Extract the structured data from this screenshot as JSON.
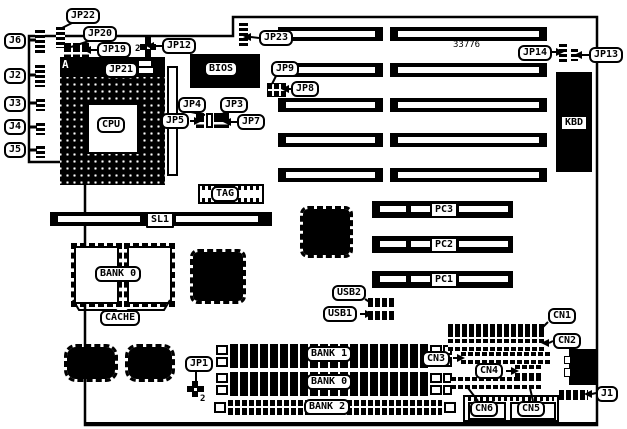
{
  "diagram_title": "motherboard-jumper-diagram",
  "colors": {
    "ink": "#000000",
    "paper": "#ffffff"
  },
  "outline": {
    "points": "29,36 233,36 233,17 597,17 597,425 85,425 85,162 29,162",
    "bottom_edge": {
      "x1": 85,
      "y1": 424,
      "x2": 597,
      "y2": 424,
      "w": 4
    }
  },
  "labels": [
    {
      "id": "jp22",
      "text": "JP22",
      "x": 66,
      "y": 8
    },
    {
      "id": "jp20",
      "text": "JP20",
      "x": 83,
      "y": 26
    },
    {
      "id": "jp19",
      "text": "JP19",
      "x": 97,
      "y": 42
    },
    {
      "id": "jp12",
      "text": "JP12",
      "x": 162,
      "y": 38
    },
    {
      "id": "jp21",
      "text": "JP21",
      "x": 104,
      "y": 62
    },
    {
      "id": "j6",
      "text": "J6",
      "x": 4,
      "y": 33
    },
    {
      "id": "j2",
      "text": "J2",
      "x": 4,
      "y": 68
    },
    {
      "id": "j3",
      "text": "J3",
      "x": 4,
      "y": 96
    },
    {
      "id": "j4",
      "text": "J4",
      "x": 4,
      "y": 119
    },
    {
      "id": "j5",
      "text": "J5",
      "x": 4,
      "y": 142
    },
    {
      "id": "jp23",
      "text": "JP23",
      "x": 259,
      "y": 30
    },
    {
      "id": "jp9",
      "text": "JP9",
      "x": 271,
      "y": 61
    },
    {
      "id": "jp8",
      "text": "JP8",
      "x": 291,
      "y": 81
    },
    {
      "id": "jp4",
      "text": "JP4",
      "x": 178,
      "y": 97
    },
    {
      "id": "jp3",
      "text": "JP3",
      "x": 220,
      "y": 97
    },
    {
      "id": "jp5",
      "text": "JP5",
      "x": 161,
      "y": 113
    },
    {
      "id": "jp7",
      "text": "JP7",
      "x": 237,
      "y": 114
    },
    {
      "id": "cpu",
      "text": "CPU",
      "x": 97,
      "y": 117
    },
    {
      "id": "bios",
      "text": "BIOS",
      "x": 204,
      "y": 61
    },
    {
      "id": "jp14",
      "text": "JP14",
      "x": 518,
      "y": 45
    },
    {
      "id": "jp13",
      "text": "JP13",
      "x": 589,
      "y": 47
    },
    {
      "id": "kbd",
      "text": "KBD",
      "x": 560,
      "y": 115,
      "variant": "flat"
    },
    {
      "id": "tag",
      "text": "TAG",
      "x": 211,
      "y": 186
    },
    {
      "id": "sl1",
      "text": "SL1",
      "x": 146,
      "y": 212,
      "variant": "flat"
    },
    {
      "id": "bank0-cache",
      "text": "BANK 0",
      "x": 95,
      "y": 266
    },
    {
      "id": "cache",
      "text": "CACHE",
      "x": 100,
      "y": 310
    },
    {
      "id": "pc3",
      "text": "PC3",
      "x": 430,
      "y": 202,
      "variant": "flat"
    },
    {
      "id": "pc2",
      "text": "PC2",
      "x": 430,
      "y": 237,
      "variant": "flat"
    },
    {
      "id": "pc1",
      "text": "PC1",
      "x": 430,
      "y": 272,
      "variant": "flat"
    },
    {
      "id": "usb2",
      "text": "USB2",
      "x": 332,
      "y": 285
    },
    {
      "id": "usb1",
      "text": "USB1",
      "x": 323,
      "y": 306
    },
    {
      "id": "jp1",
      "text": "JP1",
      "x": 185,
      "y": 356
    },
    {
      "id": "bank1",
      "text": "BANK 1",
      "x": 306,
      "y": 346
    },
    {
      "id": "bank0-simm",
      "text": "BANK 0",
      "x": 306,
      "y": 374
    },
    {
      "id": "bank2",
      "text": "BANK 2",
      "x": 304,
      "y": 399
    },
    {
      "id": "cn3",
      "text": "CN3",
      "x": 422,
      "y": 351
    },
    {
      "id": "cn1",
      "text": "CN1",
      "x": 548,
      "y": 308
    },
    {
      "id": "cn2",
      "text": "CN2",
      "x": 553,
      "y": 333
    },
    {
      "id": "cn4",
      "text": "CN4",
      "x": 475,
      "y": 363
    },
    {
      "id": "cn6",
      "text": "CN6",
      "x": 470,
      "y": 401
    },
    {
      "id": "cn5",
      "text": "CN5",
      "x": 517,
      "y": 401
    },
    {
      "id": "j1",
      "text": "J1",
      "x": 596,
      "y": 386
    }
  ],
  "texts": [
    {
      "id": "board-number",
      "text": "33776",
      "x": 453,
      "y": 41,
      "variant": "plain"
    },
    {
      "id": "pin1-marker-a",
      "text": "A",
      "x": 62,
      "y": 59,
      "variant": "inv"
    },
    {
      "id": "jp19-pin2",
      "text": "2",
      "x": 135,
      "y": 45
    },
    {
      "id": "jp1-pin2",
      "text": "2",
      "x": 200,
      "y": 395
    }
  ],
  "black_boxes": [
    {
      "id": "bios-chip",
      "x": 190,
      "y": 54,
      "w": 70,
      "h": 34
    },
    {
      "id": "kbd-connector",
      "x": 556,
      "y": 72,
      "w": 36,
      "h": 100
    },
    {
      "id": "cpu-top-header",
      "x": 60,
      "y": 57,
      "w": 105,
      "h": 20
    },
    {
      "id": "edge-connector",
      "x": 569,
      "y": 349,
      "w": 28,
      "h": 36
    }
  ],
  "socket": {
    "id": "cpu-socket",
    "x": 60,
    "y": 77,
    "w": 105,
    "h": 108
  },
  "white_boxes": [
    {
      "id": "cpu-inner-cutout",
      "x": 87,
      "y": 103,
      "w": 52,
      "h": 51,
      "b": 2
    },
    {
      "id": "cpu-side-strip",
      "x": 167,
      "y": 66,
      "w": 11,
      "h": 110,
      "b": 2
    },
    {
      "id": "top-header-slot-a",
      "x": 139,
      "y": 61,
      "w": 12,
      "h": 5,
      "b": 0
    },
    {
      "id": "top-header-slot-b",
      "x": 139,
      "y": 68,
      "w": 14,
      "h": 5,
      "b": 0
    },
    {
      "id": "edge-notch-a",
      "x": 564,
      "y": 356,
      "w": 7,
      "h": 8,
      "b": 1
    },
    {
      "id": "edge-notch-b",
      "x": 564,
      "y": 368,
      "w": 7,
      "h": 9,
      "b": 1
    }
  ],
  "qfp_chips": [
    {
      "id": "chip-qfp-a",
      "x": 190,
      "y": 249,
      "w": 56,
      "h": 55,
      "r": 8
    },
    {
      "id": "chip-qfp-b",
      "x": 300,
      "y": 206,
      "w": 53,
      "h": 52,
      "r": 8
    },
    {
      "id": "chip-blob-a",
      "x": 64,
      "y": 344,
      "w": 54,
      "h": 38,
      "r": 12
    },
    {
      "id": "chip-blob-b",
      "x": 125,
      "y": 344,
      "w": 50,
      "h": 38,
      "r": 12
    }
  ],
  "cache_chips": [
    {
      "id": "cache-chip-a",
      "x": 74,
      "y": 246,
      "w": 45,
      "h": 58
    },
    {
      "id": "cache-chip-b",
      "x": 127,
      "y": 246,
      "w": 45,
      "h": 58
    }
  ],
  "tag_chip": {
    "box": {
      "x": 198,
      "y": 184,
      "w": 66,
      "h": 20
    },
    "pins": [
      {
        "x": 202,
        "y": 186,
        "w": 58,
        "h": 4
      },
      {
        "x": 202,
        "y": 198,
        "w": 58,
        "h": 4
      }
    ]
  },
  "isa": {
    "rows_y": [
      27,
      63,
      98,
      133,
      168
    ],
    "h": 14,
    "left": {
      "x": 278,
      "w": 105
    },
    "right": {
      "x": 390,
      "w": 157
    }
  },
  "pci": {
    "rows_y": [
      201,
      236,
      271
    ],
    "x": 372,
    "w": 141,
    "h": 17
  },
  "sl1": {
    "bar": {
      "x": 50,
      "y": 212,
      "w": 222,
      "h": 14
    },
    "inners": [
      {
        "x": 58,
        "y": 216,
        "w": 82,
        "h": 6
      },
      {
        "x": 176,
        "y": 216,
        "w": 82,
        "h": 6
      }
    ]
  },
  "simm": {
    "rows_y": [
      344,
      356,
      372,
      384
    ],
    "bank2": {
      "y": 400
    }
  },
  "h_headers": [
    {
      "id": "usb2-header",
      "x": 368,
      "y": 298,
      "w": 28,
      "h": 9
    },
    {
      "id": "usb1-header",
      "x": 368,
      "y": 311,
      "w": 28,
      "h": 9
    },
    {
      "id": "cn1-header",
      "x": 448,
      "y": 324,
      "w": 97,
      "h": 13
    },
    {
      "id": "j1-header",
      "x": 559,
      "y": 390,
      "w": 29,
      "h": 10
    }
  ],
  "ladders": [
    {
      "id": "cn2-header",
      "x": 448,
      "y": 339,
      "w": 97,
      "h": 12
    },
    {
      "id": "cn3-header",
      "x": 461,
      "y": 352,
      "w": 91,
      "h": 12
    },
    {
      "id": "cn4-header",
      "x": 515,
      "y": 365,
      "w": 28,
      "h": 12
    },
    {
      "id": "cn6-header",
      "x": 451,
      "y": 377,
      "w": 64,
      "h": 12
    },
    {
      "id": "cn5-header",
      "x": 515,
      "y": 377,
      "w": 28,
      "h": 12
    }
  ],
  "v_strips": [
    {
      "id": "jp22-pins",
      "x": 56,
      "y": 25,
      "w": 9,
      "h": 23
    },
    {
      "id": "j6-pins",
      "x": 35,
      "y": 28,
      "w": 10,
      "h": 25
    },
    {
      "id": "j2-pins",
      "x": 35,
      "y": 63,
      "w": 10,
      "h": 24
    },
    {
      "id": "j3-pins",
      "x": 36,
      "y": 97,
      "w": 9,
      "h": 14
    },
    {
      "id": "j4-pins",
      "x": 36,
      "y": 121,
      "w": 9,
      "h": 14
    },
    {
      "id": "j5-pins",
      "x": 36,
      "y": 144,
      "w": 9,
      "h": 14
    },
    {
      "id": "jp23-pins",
      "x": 239,
      "y": 21,
      "w": 9,
      "h": 27
    },
    {
      "id": "jp14-pins",
      "x": 559,
      "y": 42,
      "w": 8,
      "h": 21
    },
    {
      "id": "jp13-pins",
      "x": 571,
      "y": 47,
      "w": 7,
      "h": 14
    }
  ],
  "jumper_bars": [
    {
      "id": "jp20-jumper-1",
      "x": 64,
      "y": 43,
      "w": 7,
      "h": 15
    },
    {
      "id": "jp20-jumper-2",
      "x": 73,
      "y": 43,
      "w": 7,
      "h": 15
    },
    {
      "id": "jp19-jumper",
      "x": 82,
      "y": 43,
      "w": 7,
      "h": 15
    },
    {
      "id": "jp5-jumper",
      "x": 196,
      "y": 113,
      "w": 8,
      "h": 15
    },
    {
      "id": "jp4-jumper",
      "x": 206,
      "y": 113,
      "w": 7,
      "h": 15,
      "hollow": true
    },
    {
      "id": "jp3-jumper",
      "x": 214,
      "y": 113,
      "w": 7,
      "h": 15
    },
    {
      "id": "jp7-jumper",
      "x": 221,
      "y": 113,
      "w": 8,
      "h": 15
    }
  ],
  "plus_jumpers": [
    {
      "id": "jp12-jumper",
      "x": 140,
      "y": 36,
      "w": 16,
      "h": 22
    },
    {
      "id": "jp1-jumper",
      "x": 187,
      "y": 381,
      "w": 17,
      "h": 16
    }
  ],
  "grid_block": {
    "id": "jp8-jp9-block",
    "x": 267,
    "y": 83,
    "w": 19,
    "h": 14
  },
  "bottom_block": {
    "box": {
      "x": 463,
      "y": 395,
      "w": 96,
      "h": 27
    },
    "pins": {
      "x": 468,
      "y": 397,
      "w": 86,
      "h": 4
    },
    "subs": [
      {
        "x": 468,
        "y": 402,
        "w": 38,
        "h": 18
      },
      {
        "x": 510,
        "y": 402,
        "w": 46,
        "h": 18
      }
    ]
  },
  "lines": [
    {
      "id": "jp22-line",
      "pts": [
        [
          72,
          23
        ],
        [
          60,
          29
        ]
      ]
    },
    {
      "id": "jp20-line",
      "pts": [
        [
          89,
          41
        ],
        [
          71,
          47
        ]
      ]
    },
    {
      "id": "jp19-line",
      "pts": [
        [
          98,
          50
        ],
        [
          91,
          50
        ]
      ],
      "arrow": "L"
    },
    {
      "id": "jp12-line",
      "pts": [
        [
          162,
          46
        ],
        [
          154,
          46
        ]
      ],
      "arrow": "L"
    },
    {
      "id": "jp23-line",
      "pts": [
        [
          259,
          38
        ],
        [
          251,
          37
        ]
      ],
      "arrow": "L"
    },
    {
      "id": "jp9-line",
      "pts": [
        [
          276,
          76
        ],
        [
          272,
          84
        ]
      ]
    },
    {
      "id": "jp8-line",
      "pts": [
        [
          291,
          89
        ],
        [
          289,
          89
        ]
      ],
      "arrow": "L"
    },
    {
      "id": "j6-line",
      "pts": [
        [
          28,
          40
        ],
        [
          36,
          40
        ]
      ],
      "w": 3
    },
    {
      "id": "j2-line",
      "pts": [
        [
          28,
          75
        ],
        [
          36,
          75
        ]
      ],
      "w": 3
    },
    {
      "id": "j3-line",
      "pts": [
        [
          28,
          103
        ],
        [
          37,
          103
        ]
      ],
      "w": 3
    },
    {
      "id": "j4-line",
      "pts": [
        [
          28,
          127
        ],
        [
          37,
          127
        ]
      ],
      "w": 3
    },
    {
      "id": "j5-line",
      "pts": [
        [
          28,
          150
        ],
        [
          37,
          150
        ]
      ],
      "w": 3
    },
    {
      "id": "jp5-line",
      "pts": [
        [
          190,
          121
        ],
        [
          194,
          121
        ]
      ],
      "arrow": "R"
    },
    {
      "id": "jp7-line",
      "pts": [
        [
          237,
          122
        ],
        [
          231,
          122
        ]
      ],
      "arrow": "L"
    },
    {
      "id": "jp4-line",
      "pts": [
        [
          191,
          112
        ],
        [
          205,
          115
        ]
      ]
    },
    {
      "id": "jp3-line",
      "pts": [
        [
          229,
          112
        ],
        [
          218,
          115
        ]
      ]
    },
    {
      "id": "jp14-line",
      "pts": [
        [
          552,
          52
        ],
        [
          556,
          52
        ]
      ],
      "arrow": "R"
    },
    {
      "id": "jp13-line",
      "pts": [
        [
          589,
          55
        ],
        [
          582,
          55
        ]
      ],
      "arrow": "L"
    },
    {
      "id": "usb2-line",
      "pts": [
        [
          365,
          299
        ],
        [
          371,
          303
        ]
      ]
    },
    {
      "id": "usb1-line",
      "pts": [
        [
          360,
          314
        ],
        [
          365,
          314
        ]
      ],
      "arrow": "R"
    },
    {
      "id": "jp1-line",
      "pts": [
        [
          196,
          371
        ],
        [
          196,
          382
        ]
      ]
    },
    {
      "id": "cn1-line",
      "pts": [
        [
          548,
          322
        ],
        [
          540,
          330
        ]
      ]
    },
    {
      "id": "cn2-line",
      "pts": [
        [
          553,
          341
        ],
        [
          549,
          343
        ]
      ],
      "arrow": "L"
    },
    {
      "id": "cn3-line",
      "pts": [
        [
          453,
          358
        ],
        [
          457,
          358
        ]
      ],
      "arrow": "R"
    },
    {
      "id": "cn4-line",
      "pts": [
        [
          506,
          371
        ],
        [
          511,
          371
        ]
      ],
      "arrow": "R"
    },
    {
      "id": "cn6-line",
      "pts": [
        [
          468,
          388
        ],
        [
          478,
          401
        ]
      ]
    },
    {
      "id": "cn5-line",
      "pts": [
        [
          530,
          388
        ],
        [
          533,
          401
        ]
      ]
    },
    {
      "id": "j1-line",
      "pts": [
        [
          596,
          393
        ],
        [
          592,
          394
        ]
      ],
      "arrow": "L"
    },
    {
      "id": "cache-brace",
      "pts": [
        [
          73,
          300
        ],
        [
          79,
          310
        ],
        [
          116,
          310
        ],
        [
          122,
          316
        ],
        [
          128,
          310
        ],
        [
          164,
          310
        ],
        [
          170,
          300
        ]
      ]
    }
  ]
}
